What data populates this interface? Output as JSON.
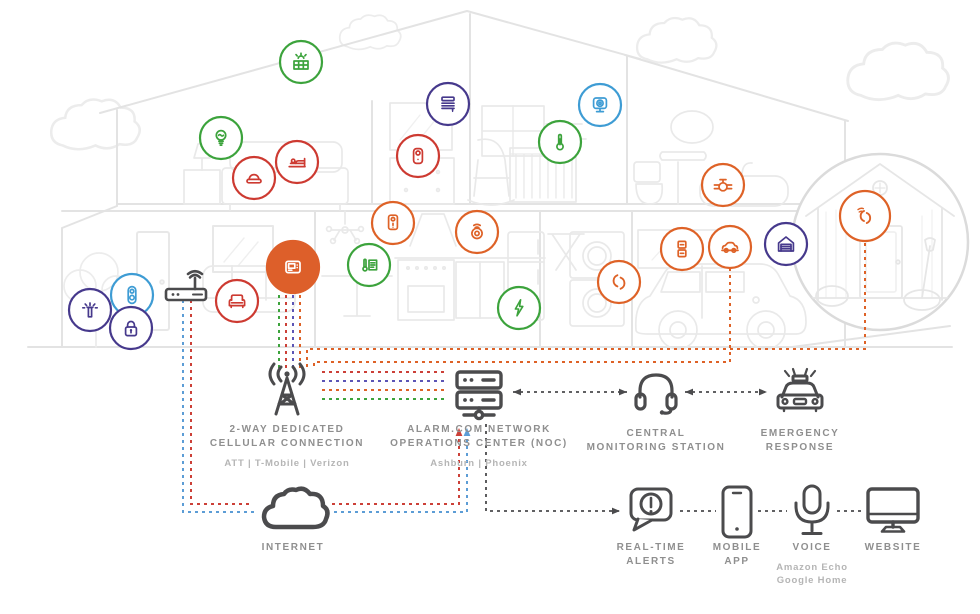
{
  "diagram_title": "Alarm.com smart home security system diagram",
  "colors": {
    "green": "#3CA33C",
    "red": "#CD3A31",
    "orange": "#DE6227",
    "indigo": "#46398C",
    "skyblue": "#3E9CD4",
    "lineRed": "#CC4038",
    "linePurple": "#5C55B5",
    "lineBlue": "#5C9DD6",
    "dark": "#4B4B4D",
    "panel_fill": "#DD5F2A",
    "label": "#8F8F8F",
    "sublabel": "#B5B5B5",
    "house_line": "#E3E3E3"
  },
  "labels": {
    "cellular": {
      "line1": "2-WAY DEDICATED",
      "line2": "CELLULAR CONNECTION",
      "sub": "ATT  |  T-Mobile  |  Verizon"
    },
    "noc": {
      "line1": "ALARM.COM NETWORK",
      "line2": "OPERATIONS CENTER (NOC)",
      "sub": "Ashburn  |  Phoenix"
    },
    "monitoring": {
      "line1": "CENTRAL",
      "line2": "MONITORING STATION"
    },
    "emergency": {
      "line1": "EMERGENCY",
      "line2": "RESPONSE"
    },
    "internet": {
      "line1": "INTERNET"
    },
    "alerts": {
      "line1": "REAL-TIME",
      "line2": "ALERTS"
    },
    "mobile": {
      "line1": "MOBILE",
      "line2": "APP"
    },
    "voice": {
      "line1": "VOICE",
      "sub1": "Amazon Echo",
      "sub2": "Google Home"
    },
    "website": {
      "line1": "WEBSITE"
    }
  },
  "house_devices": [
    {
      "name": "solar-panel",
      "icon": "solar",
      "color": "green",
      "x": 301,
      "y": 62
    },
    {
      "name": "smart-light",
      "icon": "bulb",
      "color": "green",
      "x": 221,
      "y": 138
    },
    {
      "name": "panic-button",
      "icon": "button",
      "color": "red",
      "x": 254,
      "y": 178
    },
    {
      "name": "bed-sensor",
      "icon": "bed",
      "color": "red",
      "x": 297,
      "y": 162
    },
    {
      "name": "window-shade",
      "icon": "shade",
      "color": "indigo",
      "x": 448,
      "y": 104
    },
    {
      "name": "indoor-camera",
      "icon": "camera",
      "color": "red",
      "x": 418,
      "y": 156
    },
    {
      "name": "monitoring-camera",
      "icon": "babycam",
      "color": "skyblue",
      "x": 600,
      "y": 105
    },
    {
      "name": "temperature-sensor",
      "icon": "thermo",
      "color": "green",
      "x": 560,
      "y": 142
    },
    {
      "name": "water-valve",
      "icon": "valve",
      "color": "orange",
      "x": 723,
      "y": 185
    },
    {
      "name": "irrigation-sprinkler",
      "icon": "sprinkler",
      "color": "indigo",
      "x": 90,
      "y": 310
    },
    {
      "name": "video-doorbell",
      "icon": "doorbell",
      "color": "skyblue",
      "x": 132,
      "y": 295
    },
    {
      "name": "smart-lock",
      "icon": "lock",
      "color": "indigo",
      "x": 131,
      "y": 328
    },
    {
      "name": "furniture-activity-sensor",
      "icon": "chair",
      "color": "red",
      "x": 237,
      "y": 301
    },
    {
      "name": "wall-smoke-detector",
      "icon": "detector",
      "color": "orange",
      "x": 393,
      "y": 223
    },
    {
      "name": "smart-thermostat",
      "icon": "thermostat",
      "color": "green",
      "x": 369,
      "y": 265
    },
    {
      "name": "smoke-co-detector",
      "icon": "smoke",
      "color": "orange",
      "x": 477,
      "y": 232
    },
    {
      "name": "energy-monitor",
      "icon": "bolt",
      "color": "green",
      "x": 519,
      "y": 308
    },
    {
      "name": "laundry-contact-sensor",
      "icon": "contact",
      "color": "orange",
      "x": 619,
      "y": 282
    },
    {
      "name": "window-sensor",
      "icon": "winsensor",
      "color": "orange",
      "x": 682,
      "y": 249
    },
    {
      "name": "connected-car",
      "icon": "car",
      "color": "orange",
      "x": 730,
      "y": 247
    },
    {
      "name": "garage-door-controller",
      "icon": "garage",
      "color": "indigo",
      "x": 786,
      "y": 244
    },
    {
      "name": "security-panel",
      "icon": "panel",
      "color": "orange",
      "x": 293,
      "y": 267,
      "r": 26,
      "filled": true
    },
    {
      "name": "shed-contact-sensor",
      "icon": "contactwave",
      "color": "orange",
      "x": 865,
      "y": 216,
      "r": 25
    }
  ],
  "network_nodes": [
    {
      "name": "wifi-router",
      "icon": "router",
      "x": 186,
      "y": 285,
      "w": 46,
      "h": 34
    },
    {
      "name": "cell-tower",
      "icon": "tower",
      "x": 287,
      "y": 391,
      "w": 64,
      "h": 58
    },
    {
      "name": "noc-servers",
      "icon": "servers",
      "x": 479,
      "y": 395,
      "w": 58,
      "h": 52
    },
    {
      "name": "monitoring-headset",
      "icon": "headset",
      "x": 656,
      "y": 391,
      "w": 50,
      "h": 48
    },
    {
      "name": "police-car",
      "icon": "police",
      "x": 800,
      "y": 391,
      "w": 60,
      "h": 48
    },
    {
      "name": "internet-cloud",
      "icon": "cloudicon",
      "x": 293,
      "y": 512,
      "w": 76,
      "h": 52
    },
    {
      "name": "alerts-bubble",
      "icon": "alert",
      "x": 651,
      "y": 510,
      "w": 50,
      "h": 48
    },
    {
      "name": "mobile-phone",
      "icon": "phone",
      "x": 737,
      "y": 512,
      "w": 34,
      "h": 54
    },
    {
      "name": "voice-mic",
      "icon": "mic",
      "x": 812,
      "y": 511,
      "w": 42,
      "h": 54
    },
    {
      "name": "website-monitor",
      "icon": "monitor",
      "x": 893,
      "y": 510,
      "w": 54,
      "h": 46
    }
  ],
  "connections": [
    {
      "name": "panel-down-green",
      "color": "green",
      "points": [
        [
          279,
          295
        ],
        [
          279,
          368
        ]
      ]
    },
    {
      "name": "panel-down-red",
      "color": "lineRed",
      "points": [
        [
          286,
          295
        ],
        [
          286,
          368
        ]
      ]
    },
    {
      "name": "panel-down-purple",
      "color": "linePurple",
      "points": [
        [
          293,
          295
        ],
        [
          293,
          368
        ]
      ]
    },
    {
      "name": "panel-down-orange",
      "color": "orange",
      "points": [
        [
          300,
          295
        ],
        [
          300,
          368
        ]
      ]
    },
    {
      "name": "car-to-panel",
      "color": "orange",
      "points": [
        [
          730,
          261
        ],
        [
          730,
          362
        ],
        [
          314,
          362
        ],
        [
          314,
          368
        ]
      ]
    },
    {
      "name": "shed-to-panel",
      "color": "orange",
      "points": [
        [
          865,
          243
        ],
        [
          865,
          349
        ],
        [
          307,
          349
        ],
        [
          307,
          368
        ]
      ]
    },
    {
      "name": "tower-noc-red",
      "color": "lineRed",
      "points": [
        [
          322,
          372
        ],
        [
          446,
          372
        ]
      ]
    },
    {
      "name": "tower-noc-purple",
      "color": "linePurple",
      "points": [
        [
          322,
          381
        ],
        [
          446,
          381
        ]
      ]
    },
    {
      "name": "tower-noc-orange",
      "color": "orange",
      "points": [
        [
          322,
          390
        ],
        [
          446,
          390
        ]
      ]
    },
    {
      "name": "tower-noc-green",
      "color": "green",
      "points": [
        [
          322,
          399
        ],
        [
          446,
          399
        ]
      ]
    },
    {
      "name": "router-cloud-red",
      "color": "lineRed",
      "points": [
        [
          191,
          300
        ],
        [
          191,
          504
        ],
        [
          252,
          504
        ]
      ]
    },
    {
      "name": "router-cloud-blue",
      "color": "lineBlue",
      "points": [
        [
          183,
          300
        ],
        [
          183,
          512
        ],
        [
          254,
          512
        ]
      ]
    },
    {
      "name": "cloud-noc-red",
      "color": "lineRed",
      "points": [
        [
          332,
          504
        ],
        [
          459,
          504
        ],
        [
          459,
          428
        ]
      ],
      "arrow_end": true
    },
    {
      "name": "cloud-noc-blue",
      "color": "lineBlue",
      "points": [
        [
          334,
          512
        ],
        [
          467,
          512
        ],
        [
          467,
          428
        ]
      ],
      "arrow_end": true
    },
    {
      "name": "noc-to-alerts",
      "color": "dark",
      "points": [
        [
          486,
          424
        ],
        [
          486,
          511
        ],
        [
          620,
          511
        ]
      ],
      "arrow_end": true
    },
    {
      "name": "noc-monitoring",
      "color": "dark",
      "points": [
        [
          513,
          392
        ],
        [
          627,
          392
        ]
      ],
      "arrow_start": true,
      "arrow_end": true
    },
    {
      "name": "monitoring-emergency",
      "color": "dark",
      "points": [
        [
          685,
          392
        ],
        [
          767,
          392
        ]
      ],
      "arrow_start": true,
      "arrow_end": true
    },
    {
      "name": "alerts-mobile-link",
      "color": "dark",
      "points": [
        [
          680,
          511
        ],
        [
          716,
          511
        ]
      ]
    },
    {
      "name": "mobile-voice-link",
      "color": "dark",
      "points": [
        [
          758,
          511
        ],
        [
          787,
          511
        ]
      ]
    },
    {
      "name": "voice-website-link",
      "color": "dark",
      "points": [
        [
          837,
          511
        ],
        [
          862,
          511
        ]
      ]
    }
  ]
}
